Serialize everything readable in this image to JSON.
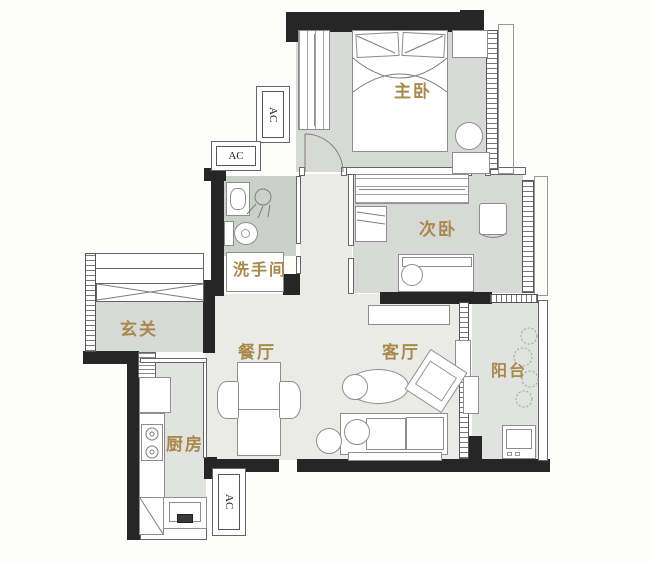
{
  "plan_title": "apartment-floor-plan",
  "rooms": {
    "master_bedroom": "主卧",
    "second_bedroom": "次卧",
    "bathroom": "洗手间",
    "entryway": "玄关",
    "dining_room": "餐厅",
    "living_room": "客厅",
    "balcony": "阳台",
    "kitchen": "厨房"
  },
  "ac_units": {
    "bedroom_side_vertical": "AC",
    "bedroom_side_horizontal": "AC",
    "kitchen_side": "AC"
  },
  "colors": {
    "label_text": "#a9884c",
    "walls": "#262626",
    "room_fill": "#d6d9d5",
    "open_area_fill": "#eaebe7",
    "furniture_outline": "#8e8e8e"
  }
}
